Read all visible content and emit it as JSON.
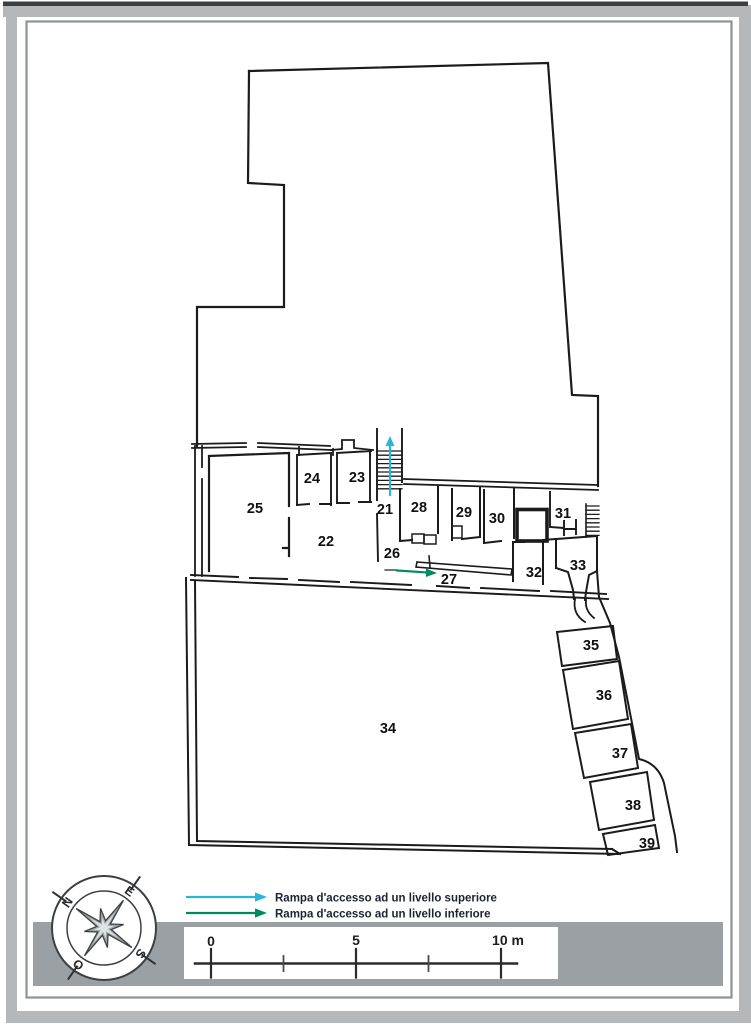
{
  "plan": {
    "rooms": [
      {
        "n": "21",
        "x": 385,
        "y": 514
      },
      {
        "n": "22",
        "x": 326,
        "y": 546
      },
      {
        "n": "23",
        "x": 357,
        "y": 482
      },
      {
        "n": "24",
        "x": 312,
        "y": 483
      },
      {
        "n": "25",
        "x": 255,
        "y": 513
      },
      {
        "n": "26",
        "x": 392,
        "y": 558
      },
      {
        "n": "27",
        "x": 449,
        "y": 584
      },
      {
        "n": "28",
        "x": 419,
        "y": 512
      },
      {
        "n": "29",
        "x": 464,
        "y": 517
      },
      {
        "n": "30",
        "x": 497,
        "y": 523
      },
      {
        "n": "31",
        "x": 563,
        "y": 518
      },
      {
        "n": "32",
        "x": 534,
        "y": 577
      },
      {
        "n": "33",
        "x": 578,
        "y": 570
      },
      {
        "n": "34",
        "x": 388,
        "y": 733
      },
      {
        "n": "35",
        "x": 591,
        "y": 650
      },
      {
        "n": "36",
        "x": 604,
        "y": 700
      },
      {
        "n": "37",
        "x": 620,
        "y": 758
      },
      {
        "n": "38",
        "x": 633,
        "y": 810
      },
      {
        "n": "39",
        "x": 647,
        "y": 848
      }
    ]
  },
  "legend": {
    "items": [
      {
        "label": "Rampa d'accesso ad un livello superiore",
        "color": "#2ab5dc"
      },
      {
        "label": "Rampa d'accesso ad un livello inferiore",
        "color": "#008a62"
      }
    ]
  },
  "scale_bar": {
    "tick_labels": [
      "0",
      "5",
      "10 m"
    ],
    "ticks_m": [
      0,
      2.5,
      5,
      7.5,
      10
    ],
    "length_m": 10
  },
  "compass": {
    "letters": [
      "N",
      "E",
      "S",
      "O"
    ]
  },
  "colors": {
    "ramp_up": "#2ab5dc",
    "ramp_down": "#008a62",
    "frame_gray": "#b4b8bb",
    "band_gray": "#9aa0a4",
    "line": "#1b1b1b"
  }
}
